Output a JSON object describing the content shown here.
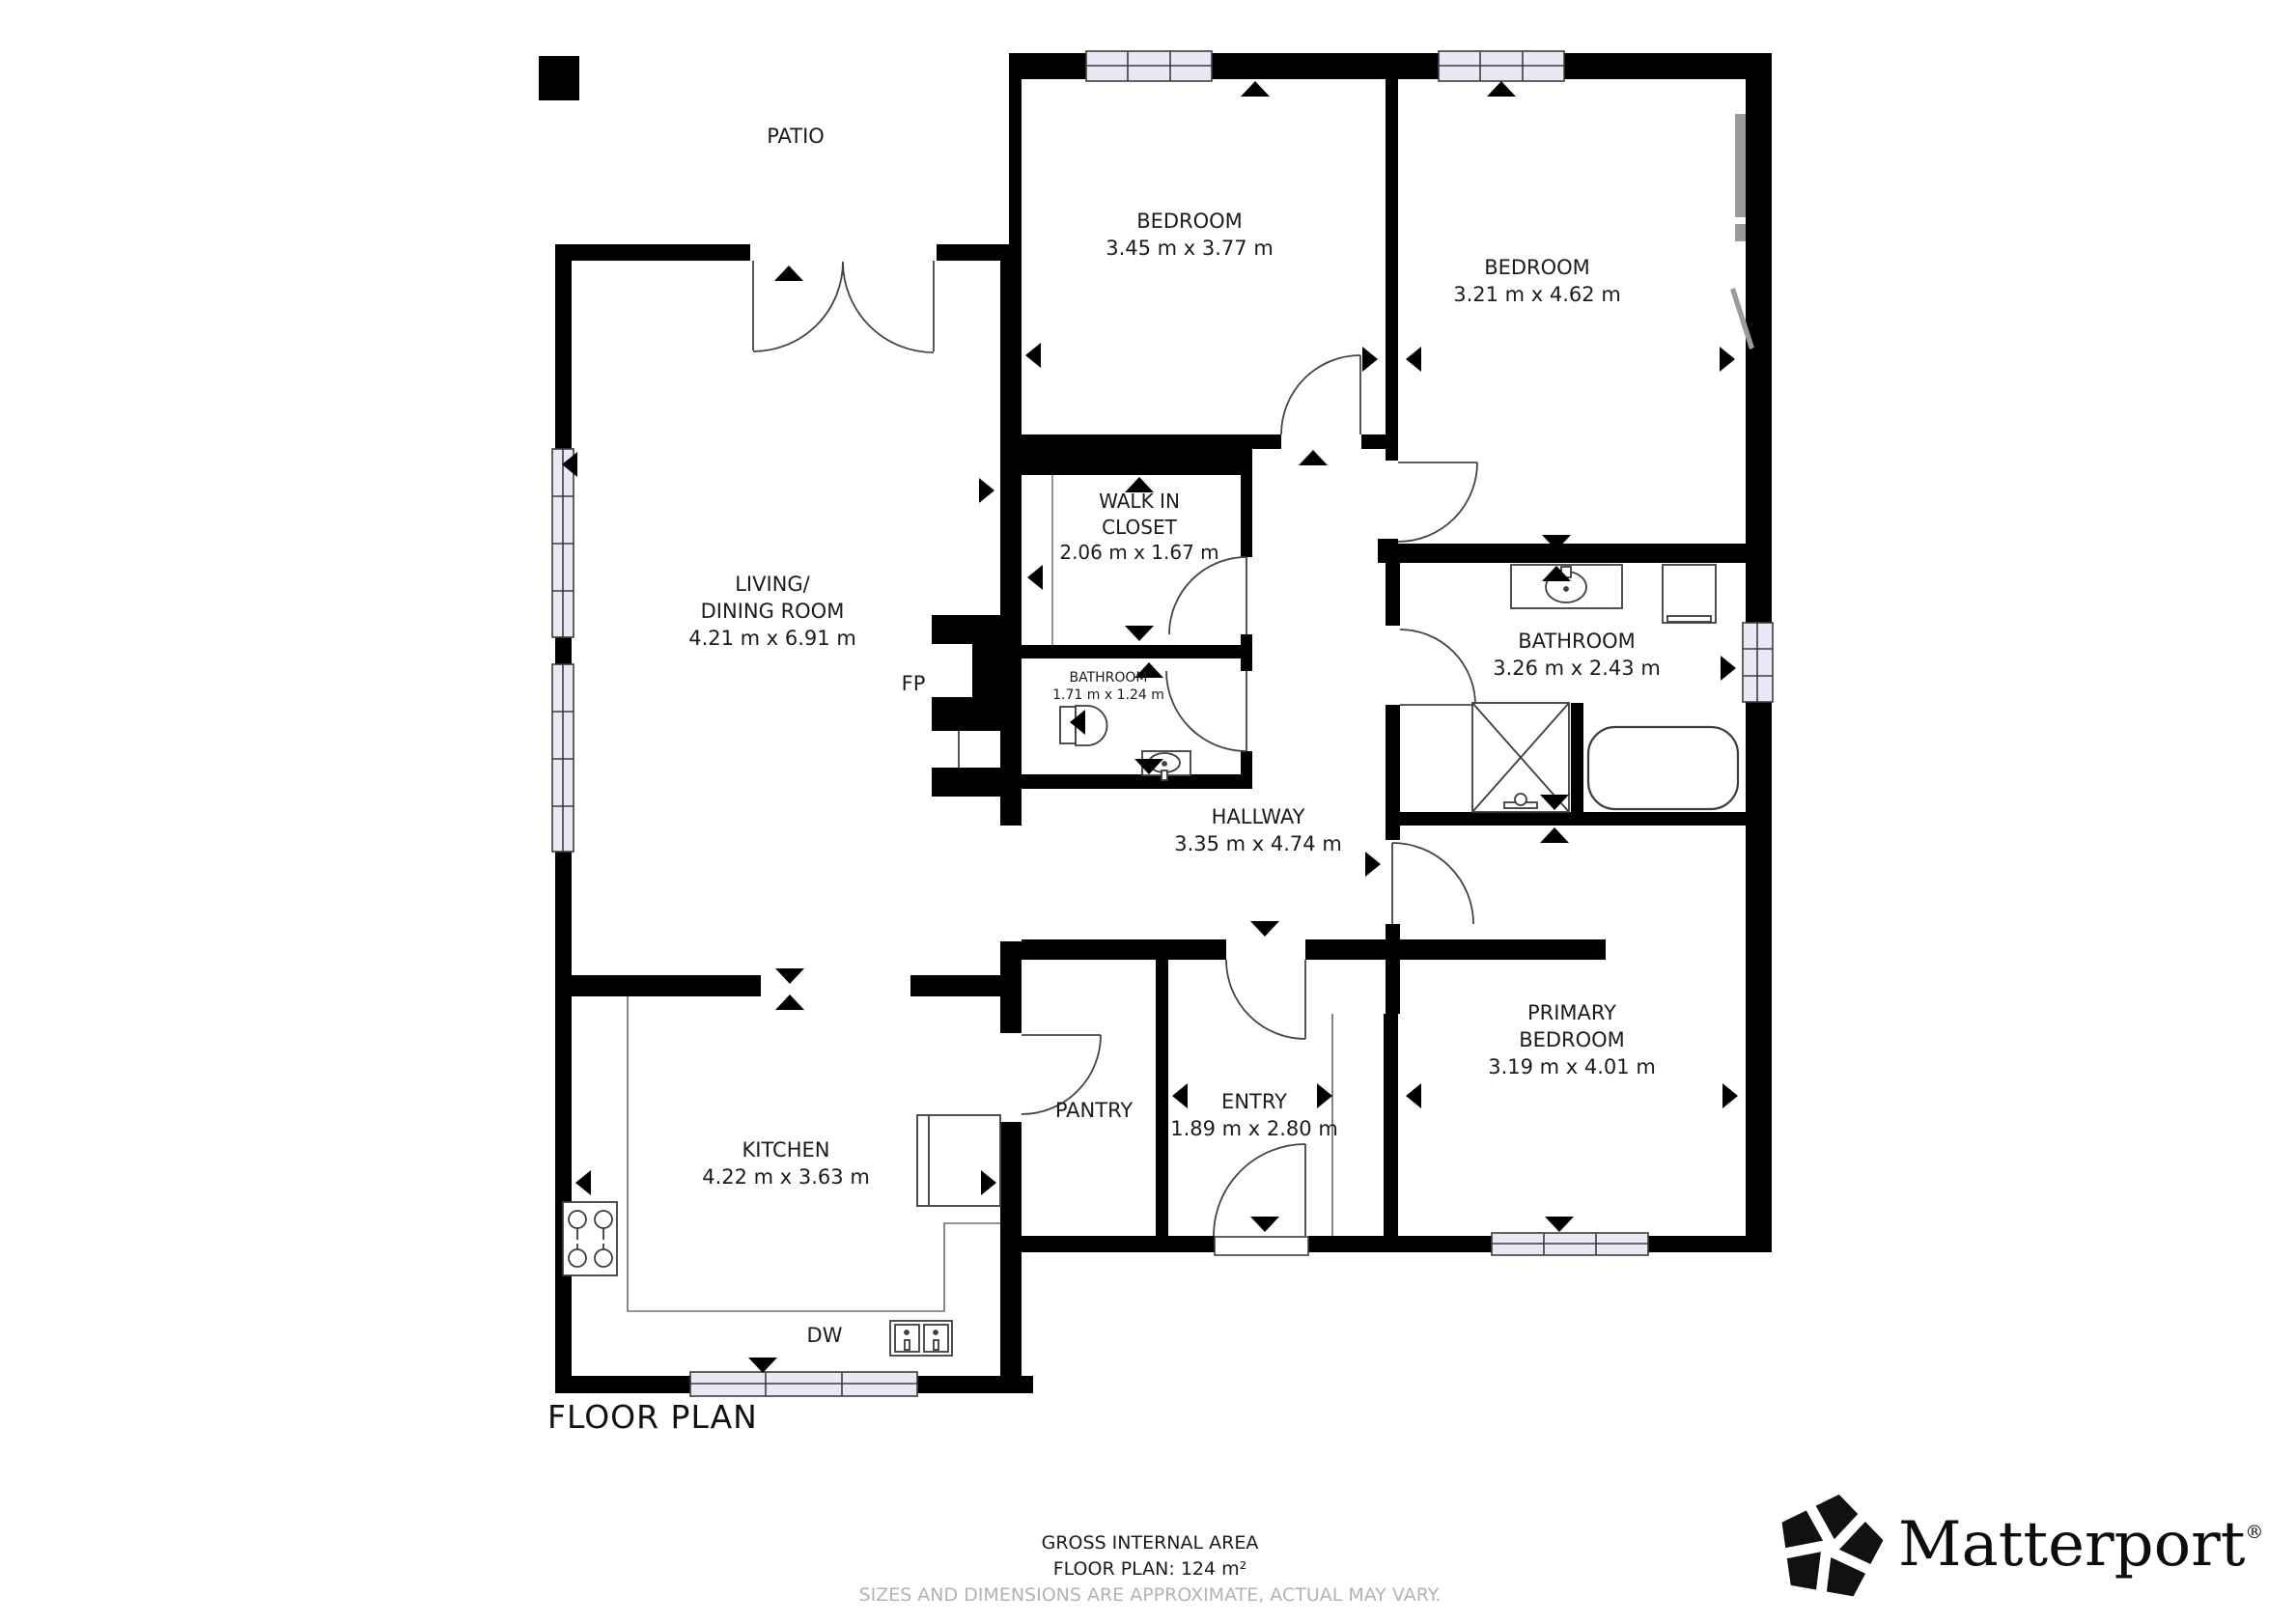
{
  "title": "FLOOR PLAN",
  "rooms": {
    "patio": {
      "line1": "PATIO"
    },
    "bedroom1": {
      "line1": "BEDROOM",
      "dims": "3.45 m x 3.77 m"
    },
    "bedroom2": {
      "line1": "BEDROOM",
      "dims": "3.21 m x 4.62 m"
    },
    "closet": {
      "line1": "WALK IN",
      "line2": "CLOSET",
      "dims": "2.06 m x 1.67 m"
    },
    "bathroom_small": {
      "line1": "BATHROOM",
      "dims": "1.71 m x 1.24 m"
    },
    "bathroom": {
      "line1": "BATHROOM",
      "dims": "3.26 m x 2.43 m"
    },
    "living": {
      "line1": "LIVING/",
      "line2": "DINING ROOM",
      "dims": "4.21 m x 6.91 m"
    },
    "hallway": {
      "line1": "HALLWAY",
      "dims": "3.35 m x 4.74 m"
    },
    "pantry": {
      "line1": "PANTRY"
    },
    "entry": {
      "line1": "ENTRY",
      "dims": "1.89 m x 2.80 m"
    },
    "primary": {
      "line1": "PRIMARY",
      "line2": "BEDROOM",
      "dims": "3.19 m x 4.01 m"
    },
    "kitchen": {
      "line1": "KITCHEN",
      "dims": "4.22 m x 3.63 m"
    }
  },
  "annotations": {
    "fireplace": "FP",
    "dishwasher": "DW"
  },
  "footer": {
    "area_label": "GROSS INTERNAL AREA",
    "area_value": "FLOOR PLAN: 124 m²",
    "disclaimer": "SIZES AND DIMENSIONS ARE APPROXIMATE, ACTUAL MAY VARY."
  },
  "brand": {
    "name": "Matterport",
    "registered": "®"
  },
  "colors": {
    "wall": "#000000",
    "window_fill": "#e9e9f5",
    "muted_text": "#b3b3b3",
    "gray_fixture": "#9a9a9a"
  }
}
